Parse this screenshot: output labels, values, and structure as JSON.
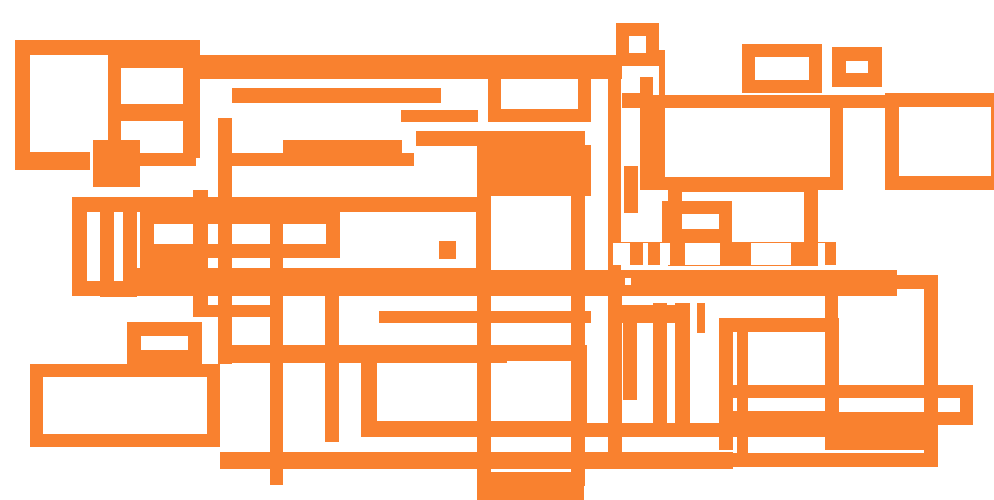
{
  "canvas": {
    "width": 994,
    "height": 500,
    "background_color": "#ffffff",
    "stroke_color": "#f9812f",
    "description": "Abstract composition of overlapping orange rectangle outlines and bars on a white background. No text or UI controls are visible."
  },
  "shapes": {
    "outlined_rects": [
      {
        "x": 15,
        "y": 40,
        "w": 185,
        "h": 118,
        "t": 15,
        "noBottom": true
      },
      {
        "x": 108,
        "y": 55,
        "w": 88,
        "h": 62,
        "t": 13
      },
      {
        "x": 108,
        "y": 108,
        "w": 88,
        "h": 58,
        "t": 13
      },
      {
        "x": 616,
        "y": 23,
        "w": 43,
        "h": 43,
        "t": 13
      },
      {
        "x": 742,
        "y": 44,
        "w": 80,
        "h": 49,
        "t": 13
      },
      {
        "x": 832,
        "y": 47,
        "w": 50,
        "h": 40,
        "t": 14
      },
      {
        "x": 488,
        "y": 65,
        "w": 103,
        "h": 57,
        "t": 13
      },
      {
        "x": 650,
        "y": 95,
        "w": 193,
        "h": 95,
        "t": 13
      },
      {
        "x": 885,
        "y": 93,
        "w": 120,
        "h": 97,
        "t": 14
      },
      {
        "x": 72,
        "y": 197,
        "w": 419,
        "h": 99,
        "t": 15
      },
      {
        "x": 100,
        "y": 197,
        "w": 37,
        "h": 100,
        "t": 14
      },
      {
        "x": 140,
        "y": 210,
        "w": 200,
        "h": 48,
        "t": 14
      },
      {
        "x": 668,
        "y": 178,
        "w": 150,
        "h": 88,
        "t": 14
      },
      {
        "x": 662,
        "y": 201,
        "w": 70,
        "h": 41,
        "t": 13
      },
      {
        "x": 477,
        "y": 131,
        "w": 108,
        "h": 355,
        "t": 14
      },
      {
        "x": 361,
        "y": 345,
        "w": 226,
        "h": 92,
        "t": 16
      },
      {
        "x": 719,
        "y": 385,
        "w": 254,
        "h": 40,
        "t": 13
      },
      {
        "x": 719,
        "y": 318,
        "w": 120,
        "h": 107,
        "t": 14
      },
      {
        "x": 825,
        "y": 275,
        "w": 113,
        "h": 175,
        "t": 13
      },
      {
        "x": 608,
        "y": 275,
        "w": 330,
        "h": 192,
        "t": 14
      },
      {
        "x": 30,
        "y": 364,
        "w": 190,
        "h": 83,
        "t": 13
      },
      {
        "x": 127,
        "y": 322,
        "w": 75,
        "h": 42,
        "t": 14
      }
    ],
    "solid_bars": [
      {
        "x": 192,
        "y": 55,
        "w": 430,
        "h": 24
      },
      {
        "x": 232,
        "y": 88,
        "w": 209,
        "h": 15
      },
      {
        "x": 401,
        "y": 110,
        "w": 77,
        "h": 12
      },
      {
        "x": 416,
        "y": 131,
        "w": 162,
        "h": 15
      },
      {
        "x": 283,
        "y": 140,
        "w": 119,
        "h": 17
      },
      {
        "x": 232,
        "y": 153,
        "w": 182,
        "h": 13
      },
      {
        "x": 15,
        "y": 152,
        "w": 75,
        "h": 18
      },
      {
        "x": 93,
        "y": 140,
        "w": 47,
        "h": 47
      },
      {
        "x": 622,
        "y": 93,
        "w": 28,
        "h": 15
      },
      {
        "x": 843,
        "y": 95,
        "w": 42,
        "h": 13
      },
      {
        "x": 220,
        "y": 345,
        "w": 287,
        "h": 18
      },
      {
        "x": 362,
        "y": 423,
        "w": 576,
        "h": 14
      },
      {
        "x": 220,
        "y": 452,
        "w": 513,
        "h": 17
      },
      {
        "x": 477,
        "y": 478,
        "w": 107,
        "h": 22
      },
      {
        "x": 491,
        "y": 270,
        "w": 406,
        "h": 26
      },
      {
        "x": 608,
        "y": 242,
        "w": 228,
        "h": 23
      },
      {
        "x": 137,
        "y": 268,
        "w": 354,
        "h": 15
      },
      {
        "x": 379,
        "y": 311,
        "w": 212,
        "h": 12
      },
      {
        "x": 491,
        "y": 145,
        "w": 100,
        "h": 51
      },
      {
        "x": 140,
        "y": 258,
        "w": 60,
        "h": 14
      },
      {
        "x": 193,
        "y": 305,
        "w": 90,
        "h": 12
      },
      {
        "x": 620,
        "y": 305,
        "w": 70,
        "h": 18
      },
      {
        "x": 439,
        "y": 241,
        "w": 17,
        "h": 18
      },
      {
        "x": 218,
        "y": 118,
        "w": 14,
        "h": 246
      },
      {
        "x": 270,
        "y": 212,
        "w": 13,
        "h": 273
      },
      {
        "x": 640,
        "y": 77,
        "w": 13,
        "h": 113
      },
      {
        "x": 659,
        "y": 50,
        "w": 6,
        "h": 140
      },
      {
        "x": 608,
        "y": 79,
        "w": 13,
        "h": 197
      },
      {
        "x": 325,
        "y": 296,
        "w": 14,
        "h": 146
      },
      {
        "x": 653,
        "y": 303,
        "w": 14,
        "h": 122
      },
      {
        "x": 675,
        "y": 303,
        "w": 15,
        "h": 132
      },
      {
        "x": 697,
        "y": 303,
        "w": 8,
        "h": 30
      },
      {
        "x": 719,
        "y": 425,
        "w": 14,
        "h": 25
      },
      {
        "x": 737,
        "y": 332,
        "w": 11,
        "h": 126
      },
      {
        "x": 193,
        "y": 190,
        "w": 15,
        "h": 127
      },
      {
        "x": 624,
        "y": 166,
        "w": 14,
        "h": 47
      },
      {
        "x": 623,
        "y": 310,
        "w": 14,
        "h": 90
      }
    ],
    "white_patches": [
      {
        "x": 685,
        "y": 243,
        "w": 35,
        "h": 22
      },
      {
        "x": 751,
        "y": 243,
        "w": 40,
        "h": 22
      },
      {
        "x": 613,
        "y": 243,
        "w": 17,
        "h": 22
      },
      {
        "x": 660,
        "y": 243,
        "w": 10,
        "h": 22
      },
      {
        "x": 818,
        "y": 243,
        "w": 7,
        "h": 22
      },
      {
        "x": 643,
        "y": 243,
        "w": 5,
        "h": 22
      },
      {
        "x": 625,
        "y": 278,
        "w": 6,
        "h": 7
      }
    ]
  }
}
